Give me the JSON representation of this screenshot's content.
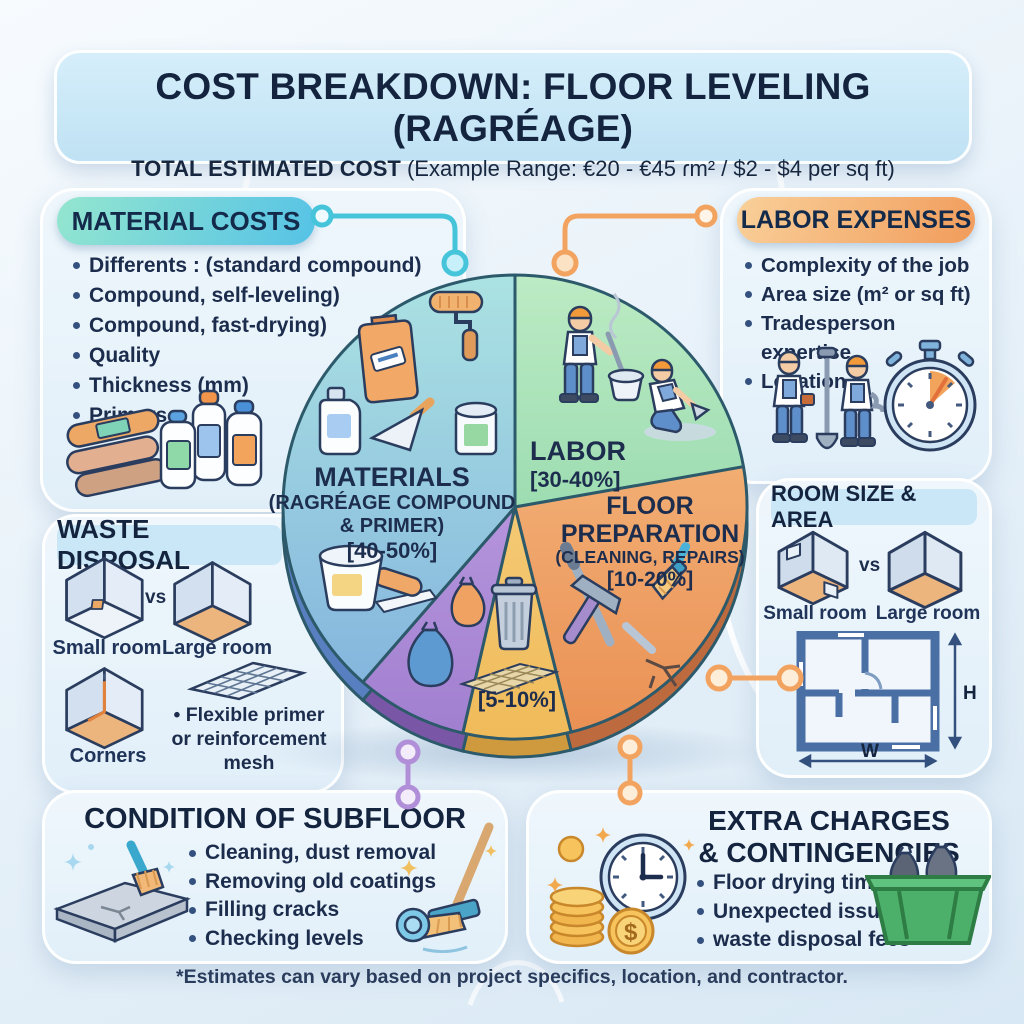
{
  "header": {
    "title": "COST BREAKDOWN: FLOOR LEVELING (RAGRÉAGE)",
    "subtitle_bold": "TOTAL ESTIMATED COST",
    "subtitle_rest": " (Example Range: €20 - €45 ɾm² / $2 - $4 per sq ft)"
  },
  "material_costs": {
    "header": "MATERIAL COSTS",
    "items": [
      "Differents : (standard compound)",
      "Compound, self-leveling)",
      "Compound, fast-drying)",
      "Quality",
      "Thickness (mm)",
      "Primers"
    ]
  },
  "labor_expenses": {
    "header": "LABOR EXPENSES",
    "items": [
      "Complexity of the job",
      "Area size (m² or sq ft)",
      "Tradesperson expertise",
      "Location"
    ]
  },
  "waste_disposal": {
    "header": "WASTE DISPOSAL",
    "small_room": "Small room",
    "vs": "vs",
    "large_room": "Large room",
    "corners": "Corners",
    "bullet": "Flexible primer or reinforcement mesh"
  },
  "room_size": {
    "header": "ROOM SIZE & AREA",
    "small_room": "Small room",
    "vs": "vs",
    "large_room": "Large room",
    "height_label": "H",
    "width_label": "W"
  },
  "condition_subfloor": {
    "header": "CONDITION OF SUBFLOOR",
    "items": [
      "Cleaning, dust removal",
      "Removing old coatings",
      "Filling cracks",
      "Checking levels"
    ]
  },
  "extra_charges": {
    "header_line1": "EXTRA CHARGES",
    "header_line2": "& CONTINGENCIES",
    "items": [
      "Floor drying time",
      "Unexpected issues",
      "waste disposal fees"
    ],
    "coin_symbol": "$"
  },
  "footer": "*Estimates can vary based on project specifics, location, and contractor.",
  "palette": {
    "teal": "#55c2e6",
    "orange": "#f2a35f",
    "purple": "#b18fd8",
    "navy": "#1d2d4e"
  },
  "chart_data": {
    "type": "pie",
    "title": "COST BREAKDOWN: FLOOR LEVELING (RAGRÉAGE)",
    "legend_position": "none",
    "center": [
      515,
      507
    ],
    "radius": 232,
    "segments": [
      {
        "name": "labor",
        "lines": [
          "LABOR",
          "[30-40%]"
        ],
        "percent_range": [
          30,
          40
        ],
        "start_angle": 0,
        "end_angle": 80,
        "color": "#7fce9e",
        "color2": "#bcebc4",
        "rim": "#4d9a74"
      },
      {
        "name": "floor-preparation",
        "lines": [
          "FLOOR",
          "PREPARATION",
          "(CLEANING, REPAIRS)",
          "[10-20%]"
        ],
        "percent_range": [
          10,
          20
        ],
        "start_angle": 80,
        "end_angle": 166,
        "color": "#ea9054",
        "color2": "#f7c289",
        "rim": "#bd6a3e"
      },
      {
        "name": "waste-disposal",
        "lines": [
          "[5-10%]"
        ],
        "percent_range": [
          5,
          10
        ],
        "start_angle": 166,
        "end_angle": 193,
        "color": "#f0bb5a",
        "color2": "#f8d88f",
        "rim": "#cf9a3e"
      },
      {
        "name": "contingency",
        "lines": [],
        "percent_range": null,
        "start_angle": 193,
        "end_angle": 221,
        "color": "#a17fd0",
        "color2": "#c9aae8",
        "rim": "#7a57a6"
      },
      {
        "name": "materials",
        "lines": [
          "MATERIALS",
          "(RAGRÉAGE COMPOUND",
          "& PRIMER)",
          "[40-50%]"
        ],
        "percent_range": [
          40,
          50
        ],
        "start_angle": 221,
        "end_angle": 360,
        "color": "#7fb0dd",
        "color2": "#abe2e2",
        "rim": "#587fc0"
      }
    ]
  }
}
